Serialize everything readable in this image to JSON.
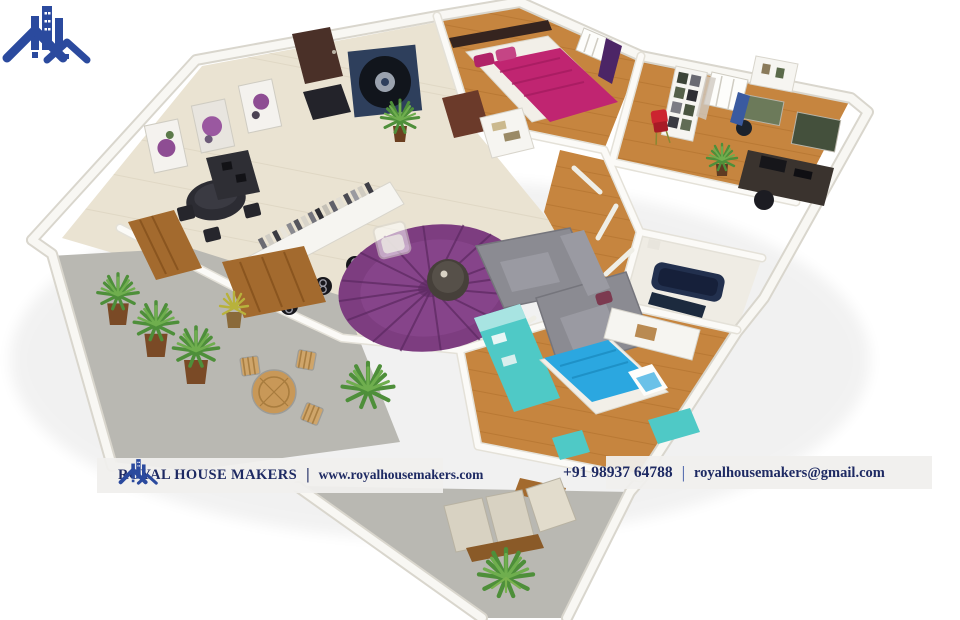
{
  "banner": {
    "brand": "ROYAL HOUSE MAKERS",
    "separator": "|",
    "website": "www.royalhousemakers.com",
    "phone": "+91 98937 64788",
    "separator2": "|",
    "email": "royalhousemakers@gmail.com"
  },
  "icons": {
    "brand_logo": "blue-house-skyline-logo"
  },
  "colors": {
    "banner_bg": "#f0efed",
    "brand_navy": "#1e2a63",
    "logo_blue": "#2b4a9e",
    "wall": "#f8f7f3",
    "wall_shadow": "#d9d6cd",
    "tile_floor": "#eae3d2",
    "wood_floor": "#c6853f",
    "wood_line": "#a96a28",
    "terrace_floor": "#b9b8b2",
    "rug_purple": "#7d3d80",
    "rug_dark": "#5e2a63",
    "sofa_gray": "#8b8b92",
    "bed_magenta": "#c02571",
    "bed_blue": "#2ba7e0",
    "cabinet_cyan": "#4fc9c6",
    "wood_panel": "#a36a2e",
    "door_brown": "#4a3028",
    "record_art": "#2e3f5c",
    "tub_navy": "#22304e",
    "accent_red": "#cc2430",
    "plant_green": "#4e8f3a",
    "lounger_beige": "#d8d2c2"
  }
}
